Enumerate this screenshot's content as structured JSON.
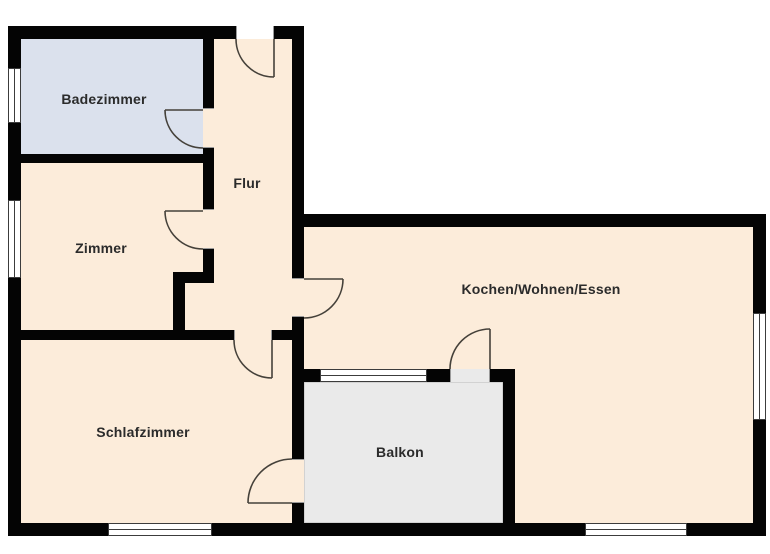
{
  "floor_plan": {
    "rooms": [
      {
        "id": "badezimmer",
        "label": "Badezimmer"
      },
      {
        "id": "zimmer",
        "label": "Zimmer"
      },
      {
        "id": "flur",
        "label": "Flur"
      },
      {
        "id": "kochen_wohnen_essen",
        "label": "Kochen/Wohnen/Essen"
      },
      {
        "id": "schlafzimmer",
        "label": "Schlafzimmer"
      },
      {
        "id": "balkon",
        "label": "Balkon"
      }
    ],
    "colors": {
      "room_fill": "#fcecda",
      "bathroom_fill": "#dbe1ed",
      "balcony_fill": "#eaeaea",
      "balcony_border": "#b9b9b9",
      "wall": "#040404",
      "door": "#45413a",
      "window_line": "#3c3c3c",
      "jamb": "#9a9a9a",
      "label_text": "#2b2b2b",
      "background": "#ffffff"
    }
  }
}
